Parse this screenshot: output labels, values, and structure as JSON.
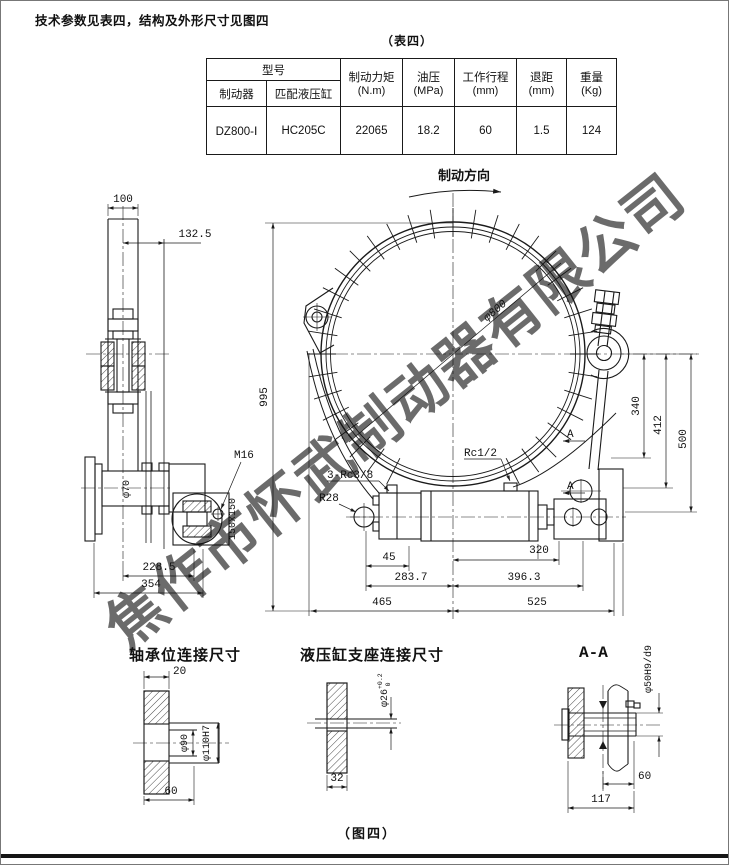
{
  "page": {
    "intro": "技术参数见表四，结构及外形尺寸见图四",
    "table_caption": "（表四）",
    "figure_caption": "（图四）",
    "watermark": "焦作市怀武制动器有限公司"
  },
  "colors": {
    "line": "#1a1a1a",
    "watermark": "#9db3d6"
  },
  "table": {
    "header": {
      "model_group": "型号",
      "brake": "制动器",
      "cylinder": "匹配液压缸",
      "torque": "制动力矩",
      "torque_unit": "(N.m)",
      "pressure": "油压",
      "pressure_unit": "(MPa)",
      "stroke": "工作行程",
      "stroke_unit": "(mm)",
      "retreat": "退距",
      "retreat_unit": "(mm)",
      "weight": "重量",
      "weight_unit": "(Kg)"
    },
    "row": {
      "brake_model": "DZ800-Ⅰ",
      "cylinder_model": "HC205C",
      "torque": "22065",
      "pressure": "18.2",
      "stroke": "60",
      "retreat": "1.5",
      "weight": "124"
    }
  },
  "drawing": {
    "direction": "制动方向",
    "main": {
      "dia": "φ800",
      "height": "995",
      "rc12": "Rc1/2",
      "rc38": "3-Rc3/8",
      "r28": "R28",
      "d45": "45",
      "d320": "320",
      "d283": "283.7",
      "d396": "396.3",
      "d465": "465",
      "d525": "525",
      "d340": "340",
      "d412": "412",
      "d500": "500",
      "section": "A"
    },
    "side": {
      "d100": "100",
      "d132": "132.5",
      "m16": "M16",
      "d70": "φ70",
      "plate": "150x150",
      "d228": "228.5",
      "d354": "354"
    },
    "bearing": {
      "title": "轴承位连接尺寸",
      "d20": "20",
      "d90": "φ90",
      "d110": "φ110H7",
      "d60": "60"
    },
    "support": {
      "title": "液压缸支座连接尺寸",
      "d26": "φ26",
      "tol_up": "+0.2",
      "tol_dn": "0",
      "d32": "32"
    },
    "aa": {
      "title": "A-A",
      "d50": "φ50H9/d9",
      "d60": "60",
      "d117": "117"
    }
  }
}
